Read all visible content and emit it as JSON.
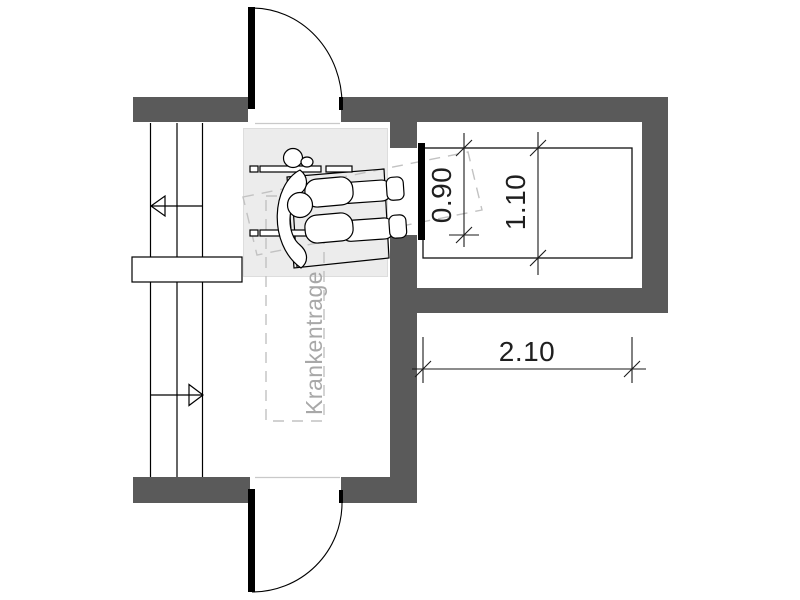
{
  "plan": {
    "type": "architectural-floor-plan",
    "subject": "Elevator lobby with stair, wheelchair user and stretcher clearance",
    "stretcher_label": "Krankentrage",
    "dimensions": {
      "door_width": "0.90",
      "car_width": "1.10",
      "car_depth": "2.10"
    },
    "colors": {
      "wall": "#5a5a5a",
      "zone_fill": "#ececec",
      "line_black": "#000000",
      "dimension_text": "#1f1f1f",
      "annotation_gray": "#c2c2c2",
      "label_gray": "#a8a8a8"
    },
    "symbols": [
      "wheelchair-user-symbol",
      "door-swing-symbol-top",
      "door-swing-symbol-bottom",
      "stair-direction-arrows",
      "stretcher-clearance-outline",
      "stretcher-tilted-outline",
      "elevator-car"
    ]
  }
}
